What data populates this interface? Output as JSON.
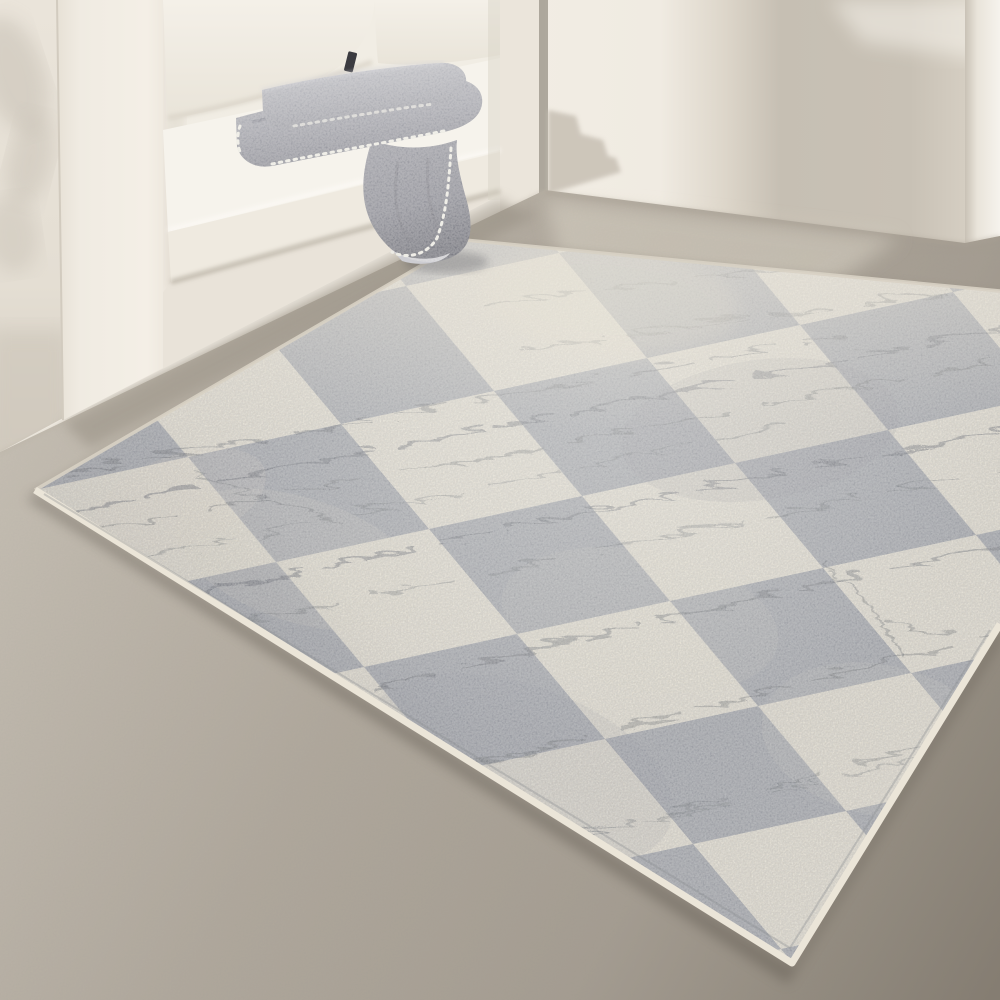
{
  "meta": {
    "description": "Sunlit interior corner: a white built-in bench niche with a cream seat cushion and pillow, a folded heather-gray blanket with whipstitch edging draped over the bench edge, warm white walls with soft cast shadows, a taupe concrete floor, and a large distressed gray and cream checkerboard area rug laid in perspective."
  },
  "scene": {
    "objects": [
      {
        "name": "left-wall",
        "label": "White wall with soft leaf shadows"
      },
      {
        "name": "bench",
        "label": "White built-in bench niche"
      },
      {
        "name": "bench-column",
        "label": "White frame column of the niche"
      },
      {
        "name": "seat-cushion",
        "label": "Cream seat cushion"
      },
      {
        "name": "back-pillow",
        "label": "White back pillow"
      },
      {
        "name": "cushion-tag",
        "label": "Small dark fabric tag"
      },
      {
        "name": "blanket",
        "label": "Folded heather-gray blanket with whipstitch edge, tail draped over the bench"
      },
      {
        "name": "back-wall",
        "label": "Warm white wall with broad soft shadow band"
      },
      {
        "name": "right-wall-panel",
        "label": "Bright white foreground wall panel"
      },
      {
        "name": "floor",
        "label": "Taupe concrete floor with sunlight patch"
      },
      {
        "name": "rug",
        "label": "Distressed checkerboard rug in gray and cream with scratch-line pattern and cream bound edges"
      }
    ],
    "rug_pattern": {
      "type": "checkerboard",
      "style": "distressed / vintage erased with scratch lines",
      "square_colors": [
        "gray",
        "cream"
      ],
      "approx_square_px": 150,
      "edge_finish": "cream binding"
    }
  },
  "colors": {
    "wall_back_lit": "#f2ede4",
    "wall_back_shadow": "#c6bfb3",
    "wall_left": "#eae4da",
    "wall_left_dark": "#d2cbbf",
    "wall_corner": "#ebe5db",
    "corner_reveal": "#a29c91",
    "wall_right_panel": "#f6f3ed",
    "bench_front": "#efe9e0",
    "bench_lower": "#e9e3d9",
    "bench_column_lit": "#f4efe6",
    "niche_back": "#f1ede4",
    "cushion_top": "#f6f3ec",
    "cushion_mid": "#efeae0",
    "cushion_front": "#e9e3d9",
    "cushion_crease": "#b3ac9f",
    "pillow": "#f4f0e8",
    "pillow_shade": "#e9e4d9",
    "tag_dark": "#3b3b40",
    "blanket_light": "#c2c3c9",
    "blanket_base": "#a3a4ac",
    "blanket_mid": "#8a8b94",
    "blanket_deep": "#6f7079",
    "blanket_stitch": "#ecebe4",
    "floor_light": "#c6bfb3",
    "floor_mid": "#a59d91",
    "floor_dark": "#857d71",
    "floor_streak": "#dcd5c7",
    "rug_gray": "#999ca3",
    "rug_gray_dark": "#7e828b",
    "rug_cream": "#e4decf",
    "rug_scratch": "#4e525b",
    "rug_binding": "#ebe5d8",
    "shadow_soft": "#938b7f",
    "shadow_deep": "#5f594f"
  }
}
